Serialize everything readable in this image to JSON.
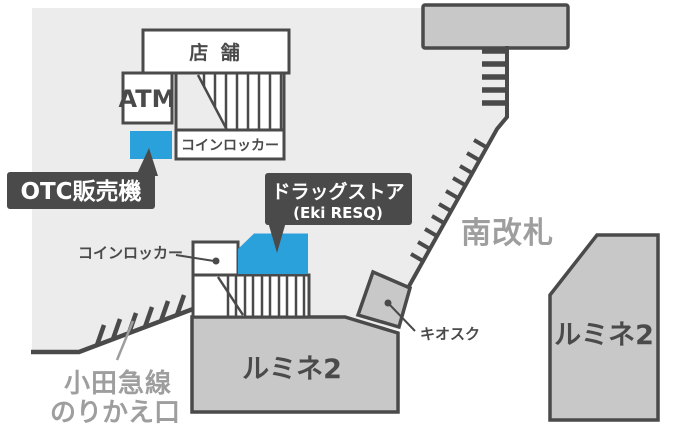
{
  "colors": {
    "highlight_blue": "#2BA1DB",
    "dark": "#4A4A4A",
    "area_gray": "#ECECEC",
    "building_gray": "#C8C8C8",
    "muted_text": "#9E9E9E"
  },
  "labels": {
    "shop": "店 舗",
    "atm": "ATM",
    "coin_locker_upper": "コインロッカー",
    "otc_machine": "OTC販売機",
    "drugstore_line1": "ドラッグストア",
    "drugstore_line2": "(Eki RESQ)",
    "coin_locker_lower": "コインロッカー",
    "south_gate": "南改札",
    "kiosk": "キオスク",
    "lumine2_bottom": "ルミネ2",
    "lumine2_right": "ルミネ2",
    "odakyu_line1": "小田急線",
    "odakyu_line2": "のりかえ口"
  }
}
